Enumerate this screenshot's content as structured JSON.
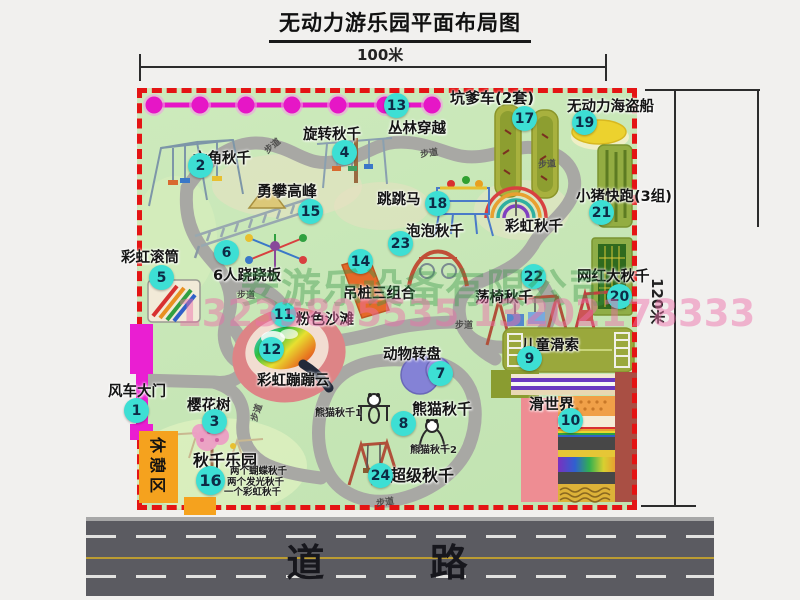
{
  "title": "无动力游乐园平面布局图",
  "dimensions": {
    "width": "100米",
    "height": "120米"
  },
  "road_label": "道 路",
  "walkway_label": "步道",
  "rest_area_label": "休憩区",
  "rainbow_swing_label": "彩虹秋千",
  "watermark": {
    "company": "安游乐设备有限公司",
    "phones": "13233805535 13202178333"
  },
  "panda_notes": [
    "熊猫秋千1",
    "熊猫秋千2"
  ],
  "swing_park_notes": [
    "两个蝴蝶秋千",
    "两个发光秋千",
    "一个彩虹秋千"
  ],
  "attractions": [
    {
      "id": 1,
      "name": "风车大门"
    },
    {
      "id": 2,
      "name": "六角秋千"
    },
    {
      "id": 3,
      "name": "樱花树"
    },
    {
      "id": 4,
      "name": "旋转秋千"
    },
    {
      "id": 5,
      "name": "彩虹滚筒"
    },
    {
      "id": 6,
      "name": "6人跷跷板"
    },
    {
      "id": 7,
      "name": "动物转盘"
    },
    {
      "id": 8,
      "name": "熊猫秋千"
    },
    {
      "id": 9,
      "name": "儿童滑索"
    },
    {
      "id": 10,
      "name": "滑世界"
    },
    {
      "id": 11,
      "name": "粉色沙滩"
    },
    {
      "id": 12,
      "name": "彩虹蹦蹦云"
    },
    {
      "id": 13,
      "name": "丛林穿越"
    },
    {
      "id": 14,
      "name": "吊桩三组合"
    },
    {
      "id": 15,
      "name": "勇攀高峰"
    },
    {
      "id": 16,
      "name": "秋千乐园"
    },
    {
      "id": 17,
      "name": "坑爹车(2套)"
    },
    {
      "id": 18,
      "name": "跳跳马"
    },
    {
      "id": 19,
      "name": "无动力海盗船"
    },
    {
      "id": 20,
      "name": "网红大秋千"
    },
    {
      "id": 21,
      "name": "小猪快跑(3组)"
    },
    {
      "id": 22,
      "name": "荡椅秋千"
    },
    {
      "id": 23,
      "name": "泡泡秋千"
    },
    {
      "id": 24,
      "name": "超级秋千"
    }
  ],
  "colors": {
    "map_green": "#c7e6b6",
    "border_red": "#e41414",
    "badge_cyan": "#3ddfd4",
    "zipline_magenta": "#e616c6",
    "gate_magenta": "#ea1ed2",
    "rest_orange": "#f5a21e",
    "road_gray": "#5b5b61",
    "path_gray": "#a8a8a4"
  }
}
